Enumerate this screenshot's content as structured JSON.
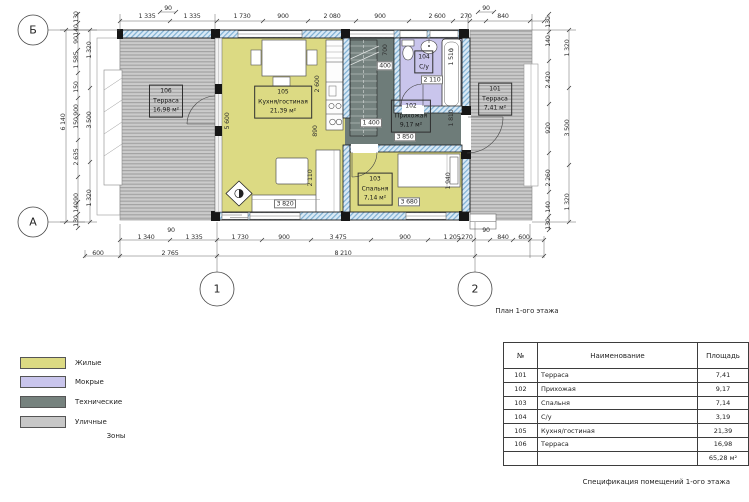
{
  "plan": {
    "caption": "План 1-ого этажа",
    "axis_markers": [
      {
        "t": "Б",
        "x": 33,
        "y": 30
      },
      {
        "t": "А",
        "x": 33,
        "y": 222
      },
      {
        "t": "1",
        "x": 217,
        "y": 289
      },
      {
        "t": "2",
        "x": 475,
        "y": 289
      }
    ],
    "rooms": [
      {
        "num": "101",
        "name": "Терраса",
        "area": "7,41 м²",
        "x": 495,
        "y": 99
      },
      {
        "num": "102",
        "name": "Прихожая",
        "area": "9,17 м²",
        "x": 411,
        "y": 116
      },
      {
        "num": "103",
        "name": "Спальня",
        "area": "7,14 м²",
        "x": 375,
        "y": 189
      },
      {
        "num": "104",
        "name": "С/у",
        "area": "",
        "x": 424,
        "y": 62
      },
      {
        "num": "105",
        "name": "Кухня/гостиная",
        "area": "21,39 м²",
        "x": 283,
        "y": 102
      },
      {
        "num": "106",
        "name": "Терраса",
        "area": "16,98 м²",
        "x": 166,
        "y": 101
      }
    ],
    "dim_labels": [
      {
        "t": "90",
        "x": 168,
        "y": 9
      },
      {
        "t": "1 335",
        "x": 147,
        "y": 17
      },
      {
        "t": "1 335",
        "x": 192,
        "y": 17
      },
      {
        "t": "1 730",
        "x": 242,
        "y": 17
      },
      {
        "t": "900",
        "x": 283,
        "y": 17
      },
      {
        "t": "2 080",
        "x": 332,
        "y": 17
      },
      {
        "t": "900",
        "x": 380,
        "y": 17
      },
      {
        "t": "2 600",
        "x": 437,
        "y": 17
      },
      {
        "t": "270",
        "x": 466,
        "y": 17
      },
      {
        "t": "90",
        "x": 486,
        "y": 9
      },
      {
        "t": "840",
        "x": 503,
        "y": 17
      },
      {
        "t": "6 140",
        "x": 64,
        "y": 122,
        "r": 1
      },
      {
        "t": "130",
        "x": 77,
        "y": 17,
        "r": 1
      },
      {
        "t": "140",
        "x": 77,
        "y": 30,
        "r": 1
      },
      {
        "t": "90",
        "x": 77,
        "y": 40,
        "r": 1
      },
      {
        "t": "1 585",
        "x": 77,
        "y": 60,
        "r": 1
      },
      {
        "t": "150",
        "x": 77,
        "y": 87,
        "r": 1
      },
      {
        "t": "900",
        "x": 77,
        "y": 110,
        "r": 1
      },
      {
        "t": "150",
        "x": 77,
        "y": 123,
        "r": 1
      },
      {
        "t": "2 635",
        "x": 77,
        "y": 157,
        "r": 1
      },
      {
        "t": "90",
        "x": 77,
        "y": 197,
        "r": 1
      },
      {
        "t": "140",
        "x": 77,
        "y": 207,
        "r": 1
      },
      {
        "t": "130",
        "x": 77,
        "y": 221,
        "r": 1
      },
      {
        "t": "1 320",
        "x": 90,
        "y": 50,
        "r": 1
      },
      {
        "t": "3 500",
        "x": 90,
        "y": 120,
        "r": 1
      },
      {
        "t": "1 320",
        "x": 90,
        "y": 198,
        "r": 1
      },
      {
        "t": "130",
        "x": 549,
        "y": 22,
        "r": 1
      },
      {
        "t": "140",
        "x": 549,
        "y": 41,
        "r": 1
      },
      {
        "t": "2 420",
        "x": 549,
        "y": 80,
        "r": 1
      },
      {
        "t": "920",
        "x": 549,
        "y": 128,
        "r": 1
      },
      {
        "t": "2 260",
        "x": 549,
        "y": 178,
        "r": 1
      },
      {
        "t": "140",
        "x": 549,
        "y": 207,
        "r": 1
      },
      {
        "t": "130",
        "x": 549,
        "y": 224,
        "r": 1
      },
      {
        "t": "1 320",
        "x": 568,
        "y": 48,
        "r": 1
      },
      {
        "t": "3 500",
        "x": 568,
        "y": 128,
        "r": 1
      },
      {
        "t": "1 320",
        "x": 568,
        "y": 202,
        "r": 1
      },
      {
        "t": "1 340",
        "x": 146,
        "y": 238
      },
      {
        "t": "90",
        "x": 171,
        "y": 231
      },
      {
        "t": "1 335",
        "x": 194,
        "y": 238
      },
      {
        "t": "1 730",
        "x": 240,
        "y": 238
      },
      {
        "t": "900",
        "x": 284,
        "y": 238
      },
      {
        "t": "3 475",
        "x": 338,
        "y": 238
      },
      {
        "t": "900",
        "x": 405,
        "y": 238
      },
      {
        "t": "1 205",
        "x": 452,
        "y": 238
      },
      {
        "t": "270",
        "x": 467,
        "y": 238
      },
      {
        "t": "90",
        "x": 486,
        "y": 231
      },
      {
        "t": "840",
        "x": 503,
        "y": 238
      },
      {
        "t": "600",
        "x": 524,
        "y": 238
      },
      {
        "t": "600",
        "x": 98,
        "y": 254
      },
      {
        "t": "2 765",
        "x": 170,
        "y": 254
      },
      {
        "t": "8 210",
        "x": 343,
        "y": 254
      },
      {
        "t": "5 600",
        "x": 228,
        "y": 121,
        "r": 1
      },
      {
        "t": "2 600",
        "x": 318,
        "y": 84,
        "r": 1
      },
      {
        "t": "890",
        "x": 316,
        "y": 131,
        "r": 1
      },
      {
        "t": "2 110",
        "x": 311,
        "y": 178,
        "r": 1
      },
      {
        "t": "3 820",
        "x": 285,
        "y": 204,
        "b": 1
      },
      {
        "t": "700",
        "x": 386,
        "y": 50,
        "r": 1
      },
      {
        "t": "400",
        "x": 385,
        "y": 66,
        "b": 1
      },
      {
        "t": "1 400",
        "x": 371,
        "y": 123,
        "b": 1
      },
      {
        "t": "3 850",
        "x": 405,
        "y": 137,
        "b": 1
      },
      {
        "t": "2 110",
        "x": 432,
        "y": 80,
        "b": 1
      },
      {
        "t": "1 510",
        "x": 452,
        "y": 57,
        "r": 1
      },
      {
        "t": "1 810",
        "x": 452,
        "y": 118,
        "r": 1
      },
      {
        "t": "3 680",
        "x": 409,
        "y": 202,
        "b": 1
      },
      {
        "t": "1 940",
        "x": 449,
        "y": 181,
        "r": 1
      }
    ]
  },
  "legend": {
    "title": "Зоны",
    "items": [
      {
        "label": "Жилые",
        "color": "#dcda83"
      },
      {
        "label": "Мокрые",
        "color": "#c9c5ec"
      },
      {
        "label": "Технические",
        "color": "#76827e"
      },
      {
        "label": "Уличные",
        "color": "#c7c7c7"
      }
    ]
  },
  "spec_table": {
    "caption": "Спецификация помещений 1-ого этажа",
    "headers": [
      "№",
      "Наименование",
      "Площадь"
    ],
    "rows": [
      [
        "101",
        "Терраса",
        "7,41"
      ],
      [
        "102",
        "Прихожая",
        "9,17"
      ],
      [
        "103",
        "Спальня",
        "7,14"
      ],
      [
        "104",
        "С/у",
        "3,19"
      ],
      [
        "105",
        "Кухня/гостиная",
        "21,39"
      ],
      [
        "106",
        "Терраса",
        "16,98"
      ]
    ],
    "total": "65,28 м²"
  }
}
